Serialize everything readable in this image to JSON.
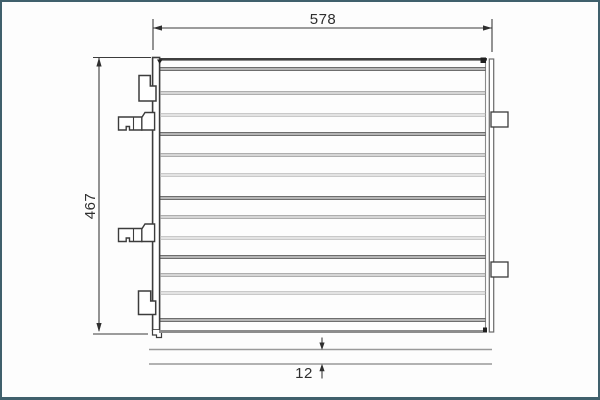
{
  "frame": {
    "border_color": "#40606c",
    "background": "#fdfdfd"
  },
  "drawing": {
    "line_color": "#3c3c3c",
    "gray_line_color": "#999999",
    "dimensions": {
      "width_label": "578",
      "height_label": "467",
      "gap_label": "12"
    }
  }
}
